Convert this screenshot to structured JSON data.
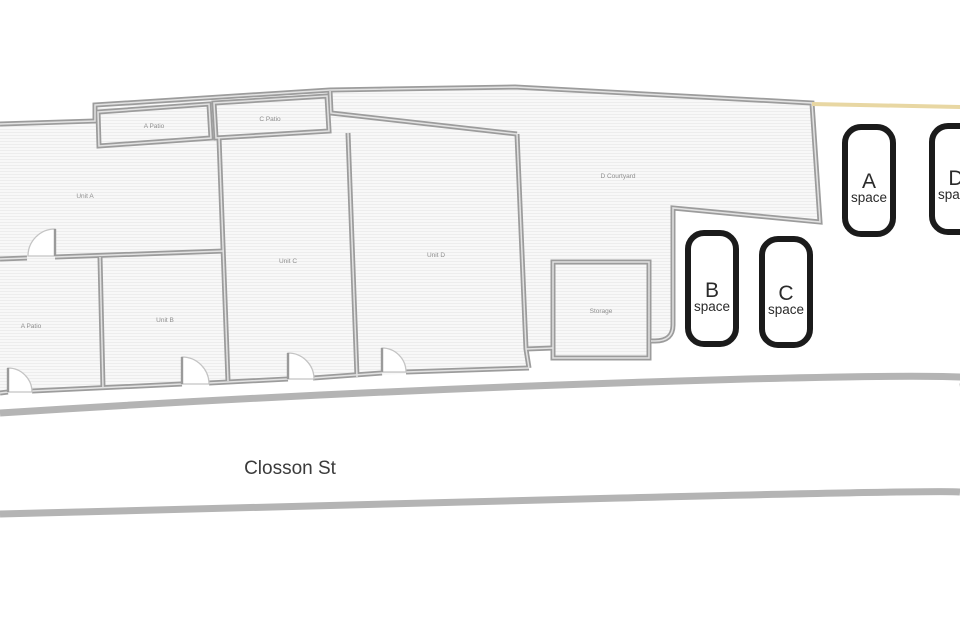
{
  "rooms": {
    "a_patio_top": "A Patio",
    "c_patio": "C Patio",
    "unit_a": "Unit A",
    "unit_b": "Unit B",
    "unit_c": "Unit C",
    "unit_d": "Unit D",
    "a_patio_bottom": "A Patio",
    "d_courtyard": "D Courtyard",
    "storage": "Storage"
  },
  "street": {
    "name": "Closson St"
  },
  "parking": [
    {
      "letter": "A",
      "caption": "space"
    },
    {
      "letter": "B",
      "caption": "space"
    },
    {
      "letter": "C",
      "caption": "space"
    },
    {
      "letter": "D",
      "caption": "space"
    }
  ],
  "colors": {
    "wall": "#9c9c9c",
    "wall_core": "#e2e2e2",
    "room_fill": "#f8f8f8",
    "hatch_line": "#ededed",
    "space_border": "#1b1b1b",
    "street_line": "#b4b4b4",
    "north_boundary_tan": "#e8d7a3",
    "room_label": "#8f8f8f",
    "text": "#3b3b3b"
  }
}
